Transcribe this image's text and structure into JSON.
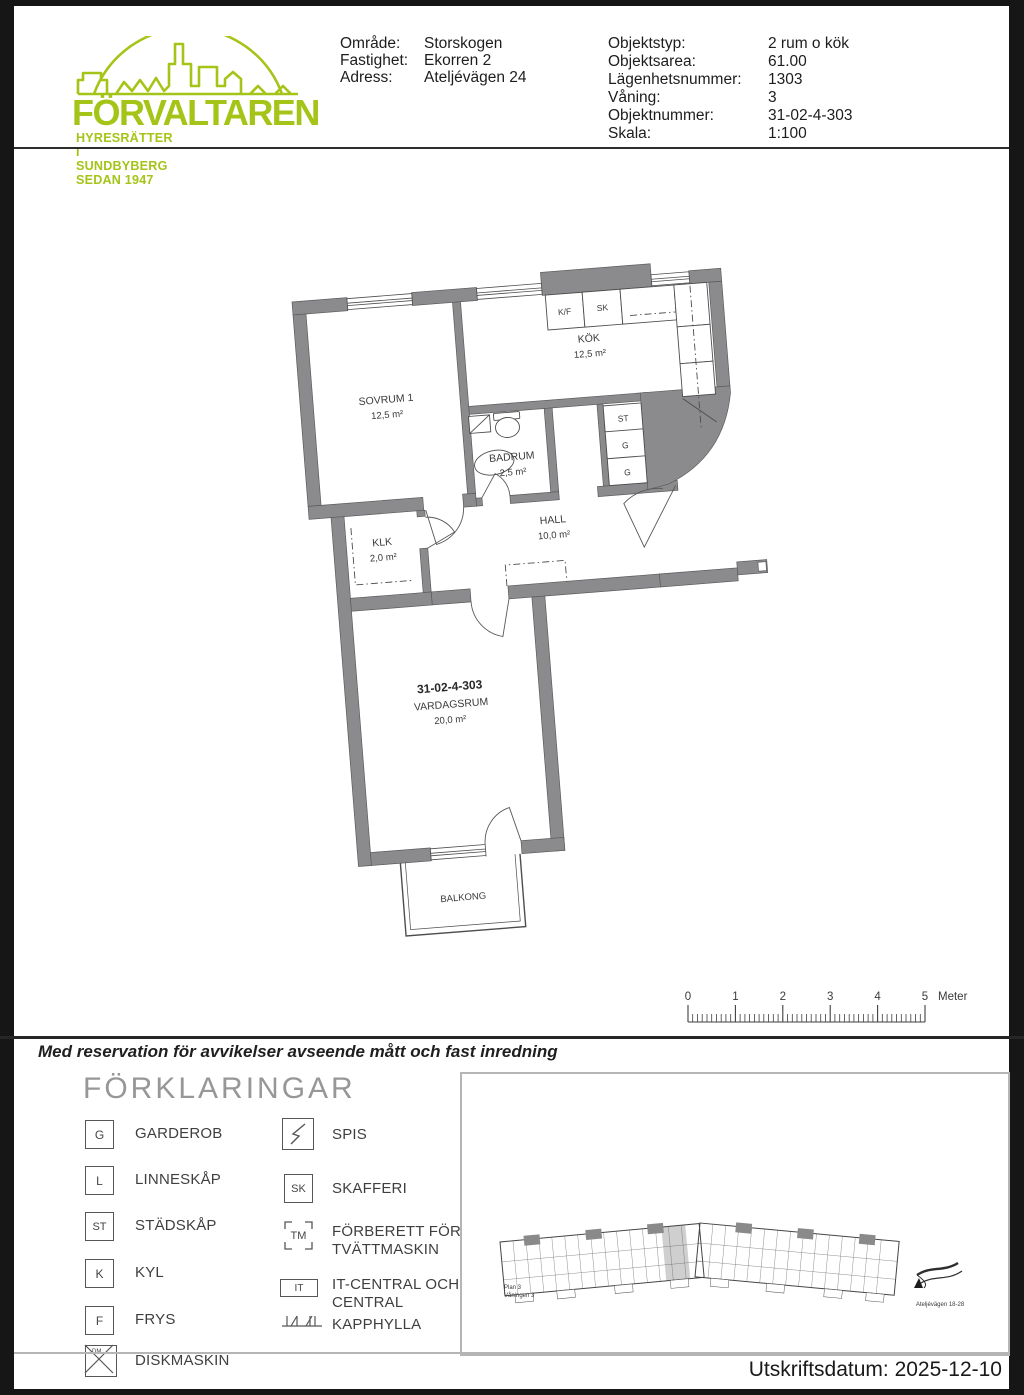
{
  "header": {
    "logo": {
      "name": "FÖRVALTAREN",
      "tagline": "HYRESRÄTTER I SUNDBYBERG SEDAN 1947",
      "color": "#a5c418"
    },
    "property_rows": [
      {
        "label": "Område:",
        "value": "Storskogen"
      },
      {
        "label": "Fastighet:",
        "value": "Ekorren 2"
      },
      {
        "label": "Adress:",
        "value": "Ateljévägen 24"
      }
    ],
    "object_rows": [
      {
        "label": "Objektstyp:",
        "value": "2 rum o kök"
      },
      {
        "label": "Objektsarea:",
        "value": "61.00"
      },
      {
        "label": "Lägenhetsnummer:",
        "value": "1303"
      },
      {
        "label": "Våning:",
        "value": "3"
      },
      {
        "label": "Objektnummer:",
        "value": "31-02-4-303"
      },
      {
        "label": "Skala:",
        "value": "1:100"
      }
    ]
  },
  "plan": {
    "apartment_id": "31-02-4-303",
    "rooms": [
      {
        "name": "SOVRUM 1",
        "area": "12,5 m²"
      },
      {
        "name": "KÖK",
        "area": "12,5 m²"
      },
      {
        "name": "BADRUM",
        "area": "2,5 m²"
      },
      {
        "name": "HALL",
        "area": "10,0 m²"
      },
      {
        "name": "KLK",
        "area": "2,0 m²"
      },
      {
        "name": "VARDAGSRUM",
        "area": "20,0 m²"
      },
      {
        "name": "BALKONG"
      }
    ],
    "fixtures": {
      "kf": "K/F",
      "sk": "SK",
      "st": "ST",
      "g1": "G",
      "g2": "G"
    }
  },
  "scalebar": {
    "labels": [
      "0",
      "1",
      "2",
      "3",
      "4",
      "5"
    ],
    "unit": "Meter"
  },
  "disclaimer": "Med reservation för avvikelser avseende mått och fast inredning",
  "legend": {
    "title": "FÖRKLARINGAR",
    "left": [
      {
        "glyph": "G",
        "label": "GARDEROB"
      },
      {
        "glyph": "L",
        "label": "LINNESKÅP"
      },
      {
        "glyph": "ST",
        "label": "STÄDSKÅP"
      },
      {
        "glyph": "K",
        "label": "KYL"
      },
      {
        "glyph": "F",
        "label": "FRYS"
      },
      {
        "glyph": "DM",
        "label": "DISKMASKIN"
      }
    ],
    "right": [
      {
        "glyph": "",
        "label": "SPIS"
      },
      {
        "glyph": "SK",
        "label": "SKAFFERI"
      },
      {
        "glyph": "TM",
        "label": "FÖRBERETT FÖR TVÄTTMASKIN"
      },
      {
        "glyph": "IT",
        "label": "IT-CENTRAL OCH EL-CENTRAL"
      },
      {
        "glyph": "",
        "label": "KAPPHYLLA"
      }
    ]
  },
  "overview": {
    "caption1": "Plan 3",
    "caption2": "Våningen 3",
    "map_label": "Ateljévägen 18-28"
  },
  "footer": {
    "print_date": "Utskriftsdatum: 2025-12-10"
  }
}
